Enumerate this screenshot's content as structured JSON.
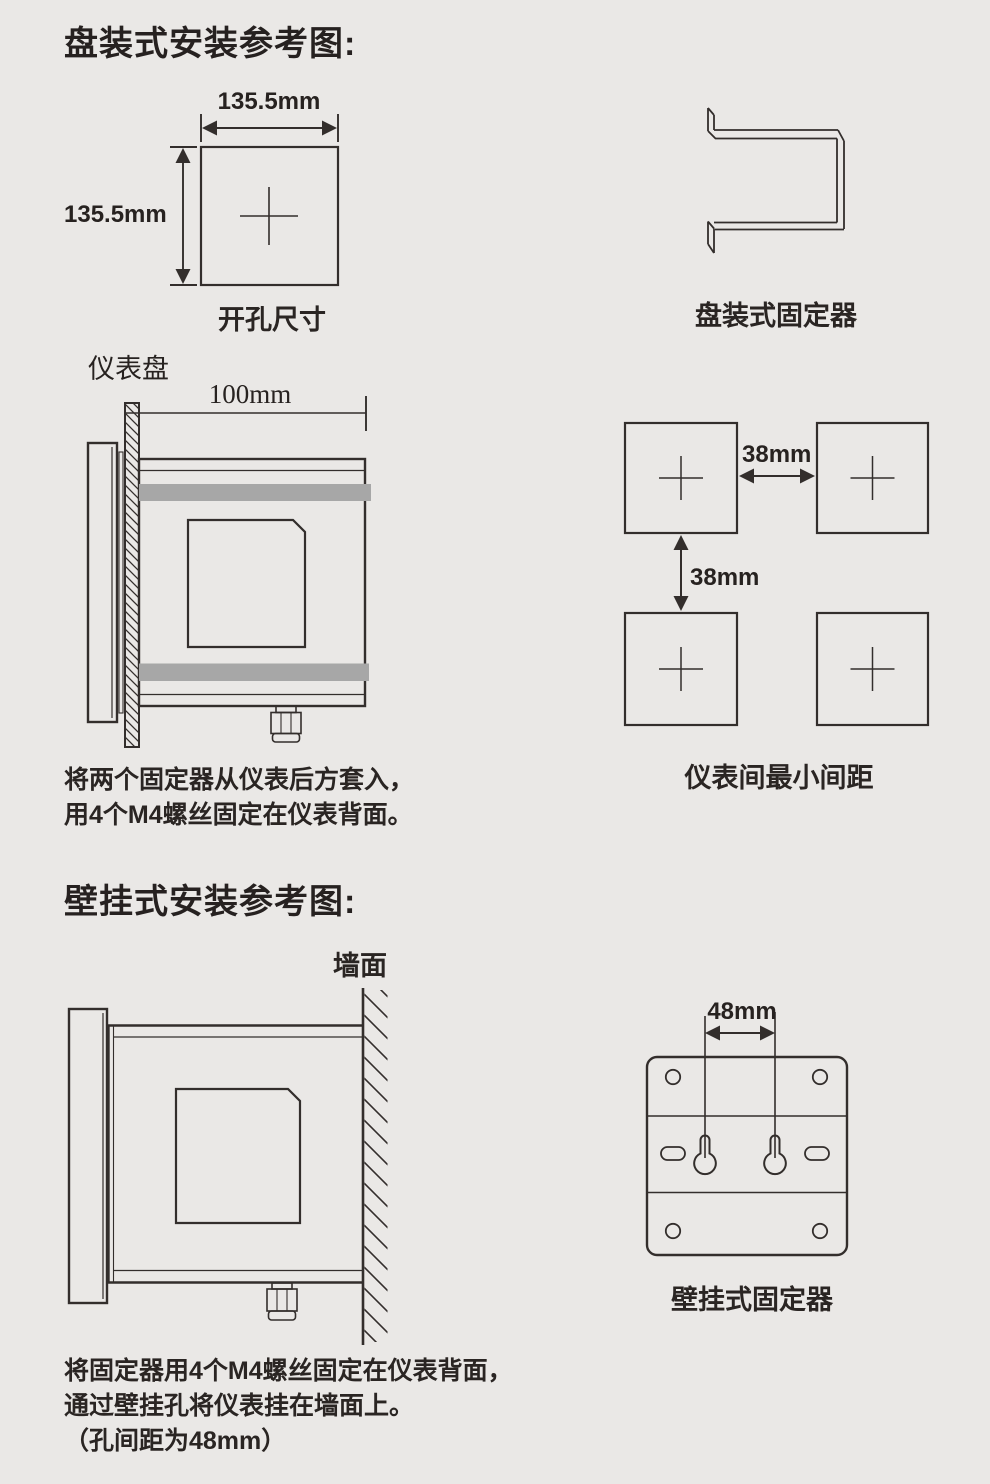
{
  "colors": {
    "background": "#eae8e6",
    "line": "#332e2c",
    "gray_bar": "#a7a7a7",
    "text": "#2a2523"
  },
  "panel_mount": {
    "title": "盘装式安装参考图:",
    "cutout_diagram": {
      "width_label": "135.5mm",
      "height_label": "135.5mm",
      "caption": "开孔尺寸"
    },
    "fixer_diagram": {
      "caption": "盘装式固定器"
    },
    "side_view": {
      "panel_label": "仪表盘",
      "depth_label": "100mm"
    },
    "spacing_diagram": {
      "horizontal_gap_label": "38mm",
      "vertical_gap_label": "38mm",
      "caption": "仪表间最小间距"
    },
    "note_lines": [
      "将两个固定器从仪表后方套入，",
      "用4个M4螺丝固定在仪表背面。"
    ]
  },
  "wall_mount": {
    "title": "壁挂式安装参考图:",
    "side_view": {
      "wall_label": "墙面"
    },
    "fixer_diagram": {
      "hole_pitch_label": "48mm",
      "caption": "壁挂式固定器"
    },
    "note_lines": [
      "将固定器用4个M4螺丝固定在仪表背面，",
      "通过壁挂孔将仪表挂在墙面上。",
      "（孔间距为48mm）"
    ]
  }
}
